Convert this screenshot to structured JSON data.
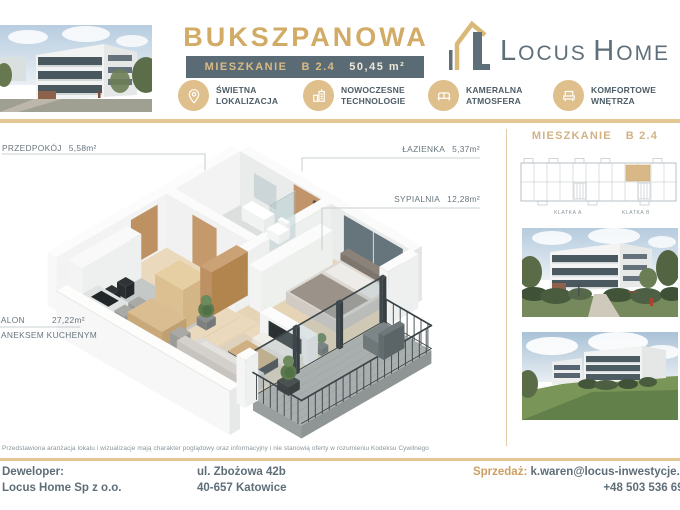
{
  "header": {
    "title": "BUKSZPANOWA",
    "unit_bar": {
      "label": "MIESZKANIE",
      "unit": "B 2.4",
      "area": "50,45 m²"
    },
    "logo": {
      "cap1": "L",
      "rest1": "OCUS",
      "cap2": "H",
      "rest2": "OME"
    },
    "features": [
      {
        "icon": "location-pin-icon",
        "line1": "ŚWIETNA",
        "line2": "LOKALIZACJA"
      },
      {
        "icon": "modern-building-icon",
        "line1": "NOWOCZESNE",
        "line2": "TECHNOLOGIE"
      },
      {
        "icon": "sofa-icon",
        "line1": "KAMERALNA",
        "line2": "ATMOSFERA"
      },
      {
        "icon": "armchair-icon",
        "line1": "KOMFORTOWE",
        "line2": "WNĘTRZA"
      }
    ]
  },
  "floorplan": {
    "rooms": [
      {
        "name": "PRZEDPOKÓJ",
        "area": "5,58m²"
      },
      {
        "name": "ŁAZIENKA",
        "area": "5,37m²"
      },
      {
        "name": "SYPIALNIA",
        "area": "12,28m²"
      },
      {
        "name": "SALON",
        "area": "27,22m²",
        "line2": "ANEKSEM KUCHENYM"
      }
    ]
  },
  "sidebar": {
    "unit_label": "MIESZKANIE",
    "unit_number": "B 2.4",
    "building_plan": {
      "klatka_a": "KLATKA A",
      "klatka_b": "KLATKA B"
    }
  },
  "footer": {
    "disclaimer": "Przedstawiona aranżacja lokalu i wizualizacje mają charakter poglądowy oraz informacyjny i nie stanowią oferty w rozumieniu Kodeksu Cywilnego",
    "developer_label": "Deweloper:",
    "developer_name": "Locus Home Sp z o.o.",
    "address_line1": "ul. Zbożowa 42b",
    "address_line2": "40-657 Katowice",
    "sales_label": "Sprzedaż:",
    "sales_email": "k.waren@locus-inwestycje.pl",
    "phone": "+48 503 536 699"
  },
  "colors": {
    "gold": "#d2ab66",
    "slate_bar": "#5a6b76",
    "rule_gold": "#e3c795",
    "text": "#5e6e78"
  }
}
